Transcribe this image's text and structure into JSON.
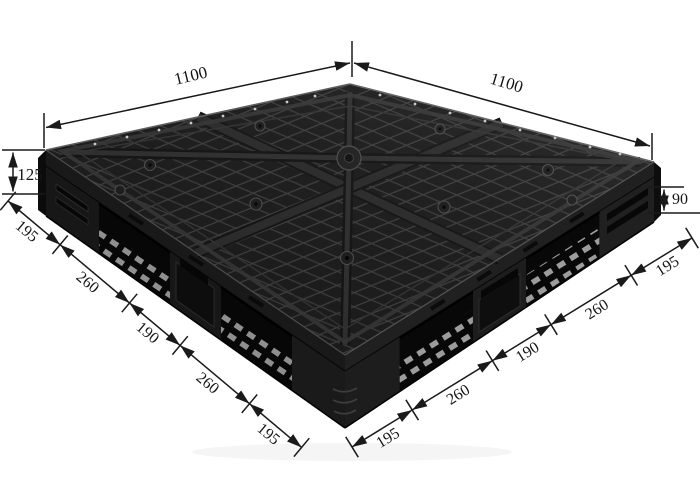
{
  "figure": {
    "subject": "black plastic grid-top pallet, corner perspective photo with dimension callouts",
    "background_color": "#ffffff",
    "pallet_color": "#141414",
    "rib_highlight_color": "#3b3b3b",
    "dimension_line_color": "#1a1a1a"
  },
  "dims": {
    "top_left_edge": "1100",
    "top_right_edge": "1100",
    "left_height": "125",
    "right_height": "90",
    "left_edge_segments": [
      "195",
      "260",
      "190",
      "260",
      "195"
    ],
    "right_edge_segments": [
      "195",
      "260",
      "190",
      "260",
      "195"
    ]
  }
}
